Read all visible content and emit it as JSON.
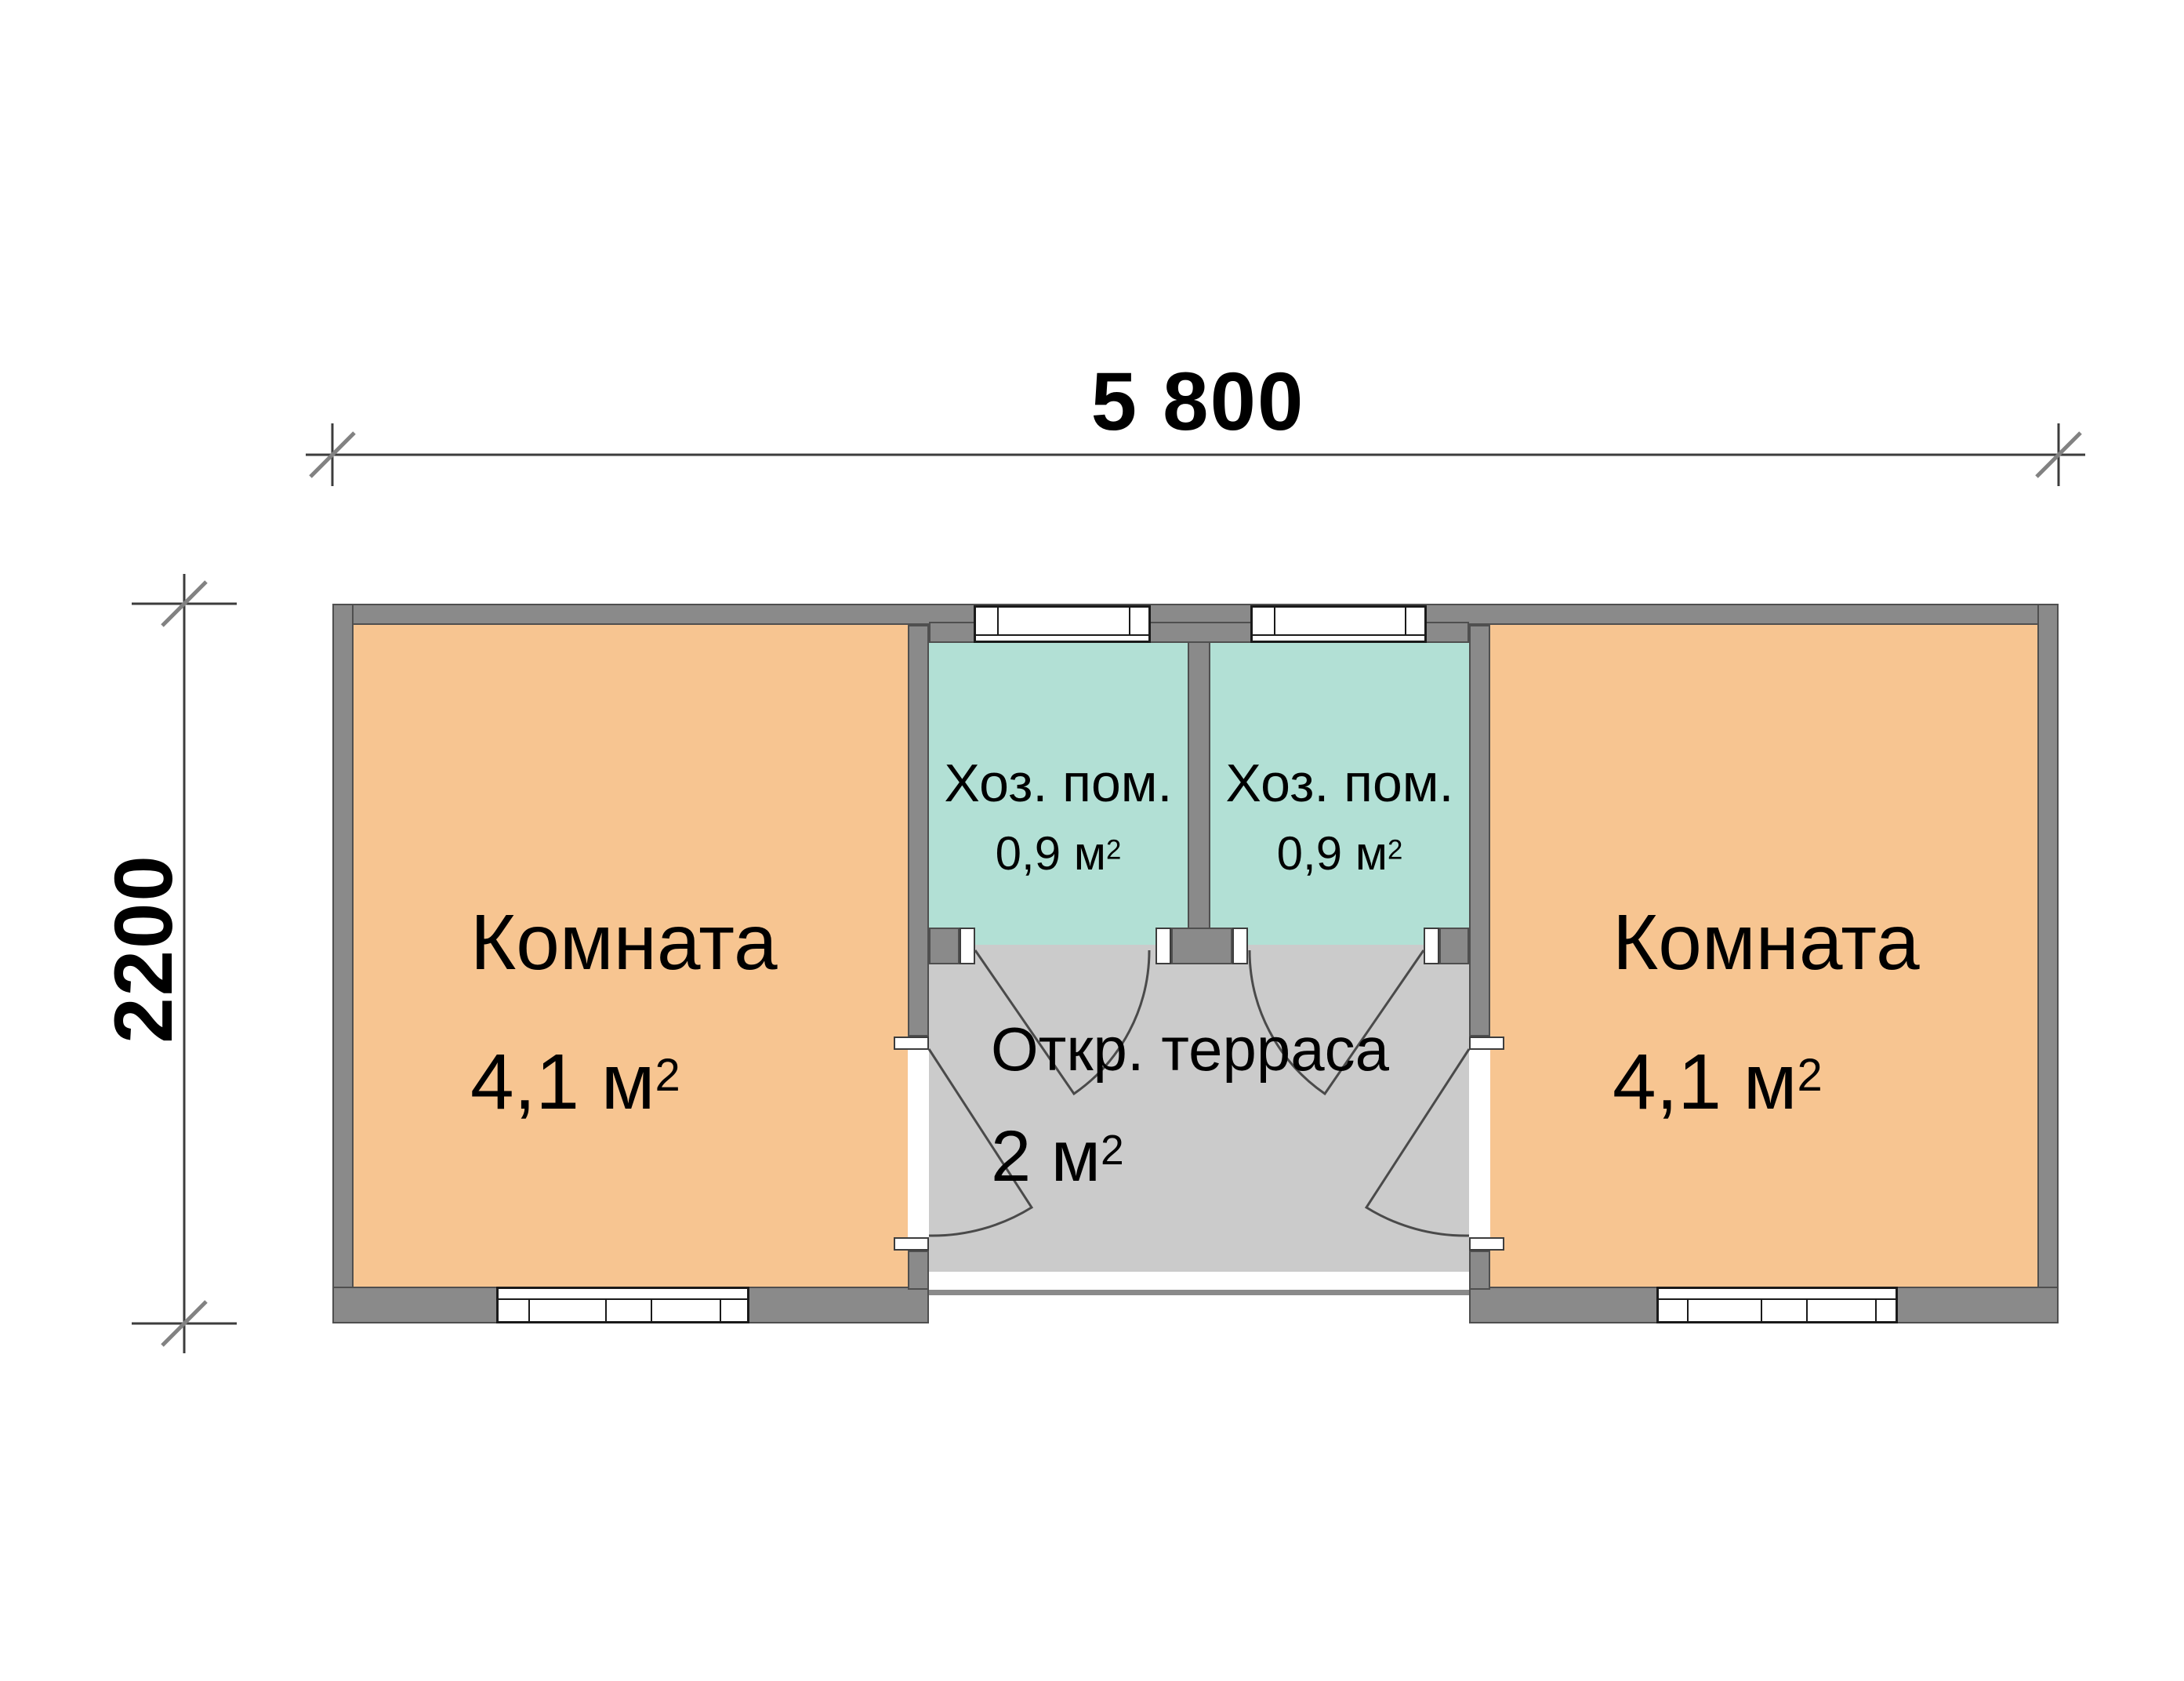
{
  "dimension_labels": {
    "width": "5 800",
    "height": "2200"
  },
  "rooms": {
    "room_left": {
      "name": "Комната",
      "area_main": "4,1 м",
      "area_sup": "2"
    },
    "room_right": {
      "name": "Комната",
      "area_main": "4,1 м",
      "area_sup": "2"
    },
    "utility_left": {
      "name": "Хоз. пом.",
      "area_main": "0,9 м",
      "area_sup": "2"
    },
    "utility_right": {
      "name": "Хоз. пом.",
      "area_main": "0,9 м",
      "area_sup": "2"
    },
    "terrace": {
      "name": "Откр. терраса",
      "area_main": "2 м",
      "area_sup": "2"
    }
  },
  "colors": {
    "room_fill": "#f7c591",
    "utility_fill": "#b2e0d5",
    "terrace_fill": "#cbcbcb",
    "wall_fill": "#8a8a8a",
    "wall_edge": "#4f4f4f",
    "window_frame": "#1a1a1a",
    "dim_line": "#3c3c3c",
    "tick": "#828282",
    "door_line": "#4a4a4a"
  }
}
